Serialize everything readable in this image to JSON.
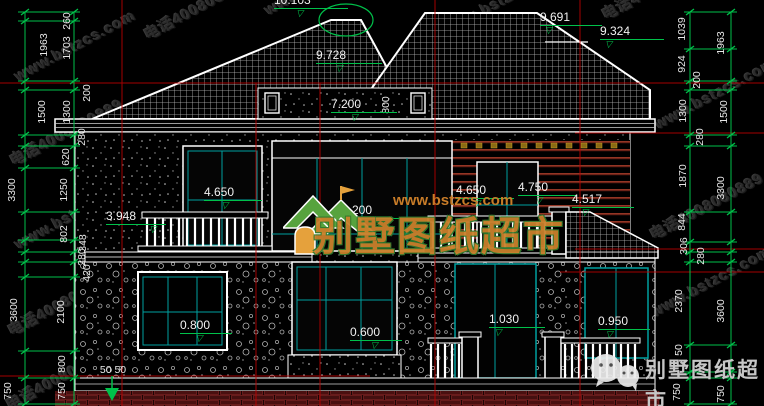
{
  "watermark": {
    "site": "www.bstzcs.com",
    "phone": "电话4008080889",
    "brand": "别墅图纸超市"
  },
  "logo": {
    "brand": "别墅图纸超市",
    "site": "www.bstzcs.com"
  },
  "footer": {
    "brand": "别墅图纸超市"
  },
  "dims": {
    "left_outer": [
      "1963",
      "1500",
      "3300",
      "3600",
      "750"
    ],
    "left_inner": [
      "260",
      "1703",
      "200",
      "1300",
      "280",
      "620",
      "1250",
      "802",
      "348",
      "280",
      "420",
      "2100",
      "800",
      "750"
    ],
    "left_base": "50 50",
    "right_inner": [
      "1039",
      "924",
      "200",
      "1300",
      "280",
      "1870",
      "844",
      "306",
      "280",
      "2370",
      "50",
      "750"
    ],
    "right_outer": [
      "1963",
      "1500",
      "3300",
      "3600",
      "750"
    ],
    "roof_height": "800"
  },
  "elevations": {
    "ridge_left": "10.103",
    "roof_left": "9.728",
    "ridge_right": "9.691",
    "roof_right": "9.324",
    "eave": "7.200",
    "floor2_left": "4.650",
    "floor2_center": "4.200",
    "floor2_right_a": "4.650",
    "floor2_right_b": "4.750",
    "floor2_far_right": "4.517",
    "balcony": "3.948",
    "floor1_left": "0.800",
    "floor1_center": "0.600",
    "floor1_door": "1.030",
    "floor1_right": "0.950"
  },
  "colors": {
    "grid_red": "#c00000",
    "dim_green": "#00c14a",
    "frame_cyan": "#00a0a0",
    "logo_green": "#57a33e",
    "logo_orange": "#c9802b"
  }
}
